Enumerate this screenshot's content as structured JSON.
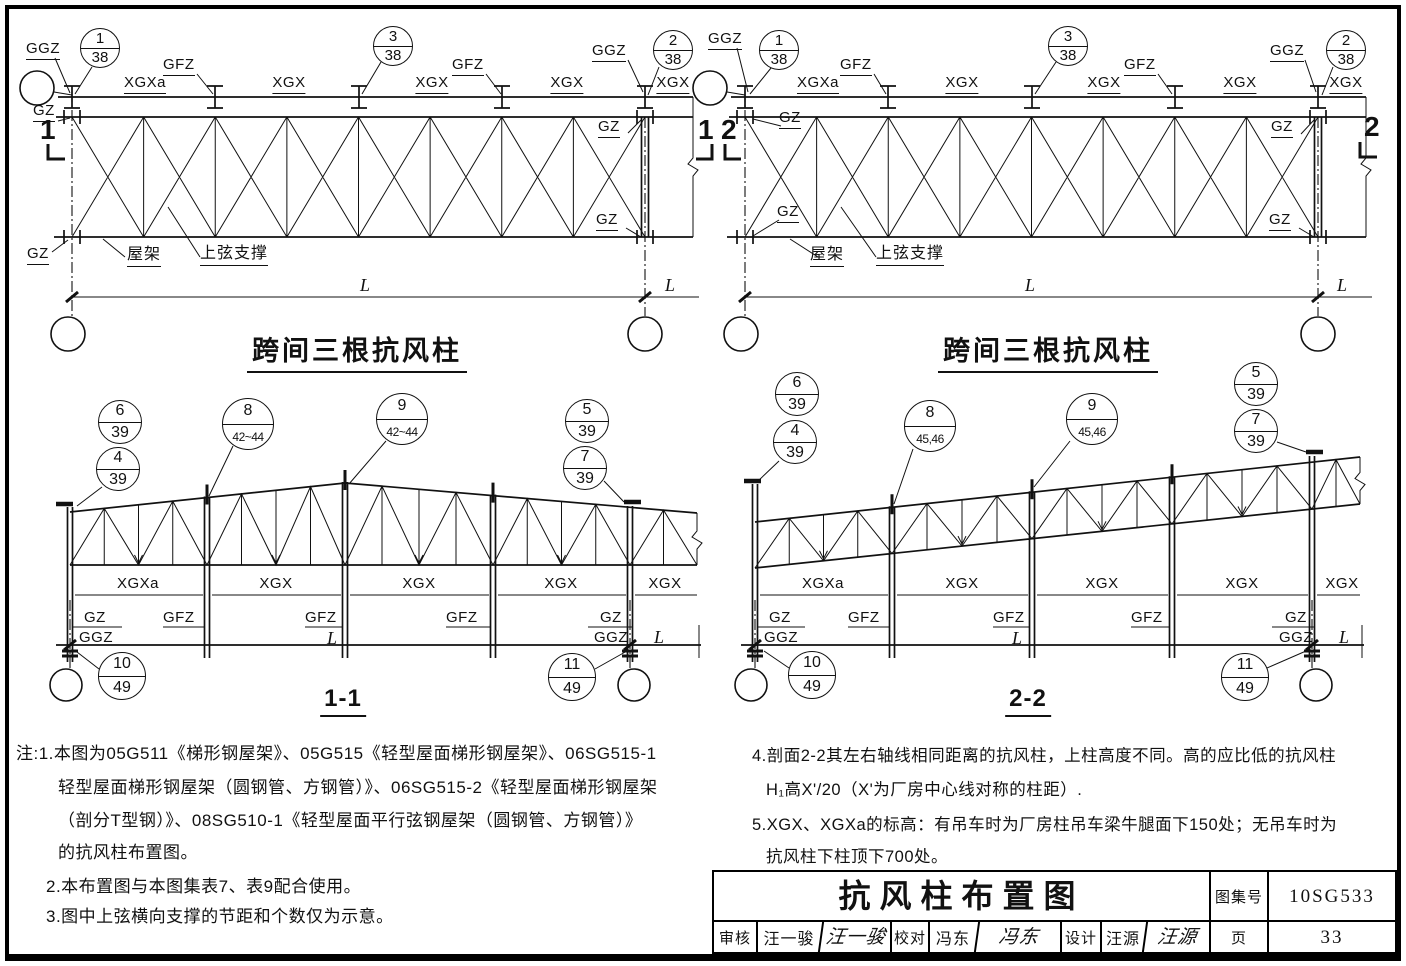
{
  "lab": {
    "ggz": "GGZ",
    "gz": "GZ",
    "gfz": "GFZ",
    "xgx": "XGX",
    "xgxa": "XGXa",
    "wujia": "屋架",
    "shangxian": "上弦支撑",
    "L": "L",
    "plan_title": "跨间三根抗风柱",
    "s11": "1-1",
    "s22": "2-2",
    "m1": "1",
    "m2": "2"
  },
  "bub": {
    "n1": "1",
    "n2": "2",
    "n3": "3",
    "n4": "4",
    "n5": "5",
    "n6": "6",
    "n7": "7",
    "n8": "8",
    "n9": "9",
    "n10": "10",
    "n11": "11",
    "p38": "38",
    "p39": "39",
    "p4244": "42~44",
    "p4546": "45,46",
    "p49": "49"
  },
  "notes": {
    "n1a": "注:1.本图为05G511《梯形钢屋架》、05G515《轻型屋面梯形钢屋架》、06SG515-1",
    "n1b": "轻型屋面梯形钢屋架（圆钢管、方钢管）》、06SG515-2《轻型屋面梯形钢屋架",
    "n1c": "（剖分T型钢）》、08SG510-1《轻型屋面平行弦钢屋架（圆钢管、方钢管）》",
    "n1d": "的抗风柱布置图。",
    "n2": "2.本布置图与本图集表7、表9配合使用。",
    "n3": "3.图中上弦横向支撑的节距和个数仅为示意。",
    "n4a": "4.剖面2-2其左右轴线相同距离的抗风柱，上柱高度不同。高的应比低的抗风柱",
    "n4b": "H₁高X'/20（X'为厂房中心线对称的柱距）.",
    "n5a": "5.XGX、XGXa的标高：有吊车时为厂房柱吊车梁牛腿面下150处；无吊车时为",
    "n5b": "抗风柱下柱顶下700处。"
  },
  "tb": {
    "title": "抗风柱布置图",
    "atlas_label": "图集号",
    "atlas_no": "10SG533",
    "page_label": "页",
    "page_no": "33",
    "shenhe": "审核",
    "shenhe_name": "汪一骏",
    "shenhe_sig": "汪一骏",
    "jiaodui": "校对",
    "jiaodui_name": "冯东",
    "jiaodui_sig": "冯东",
    "sheji": "设计",
    "sheji_name": "汪源",
    "sheji_sig": "汪源"
  }
}
